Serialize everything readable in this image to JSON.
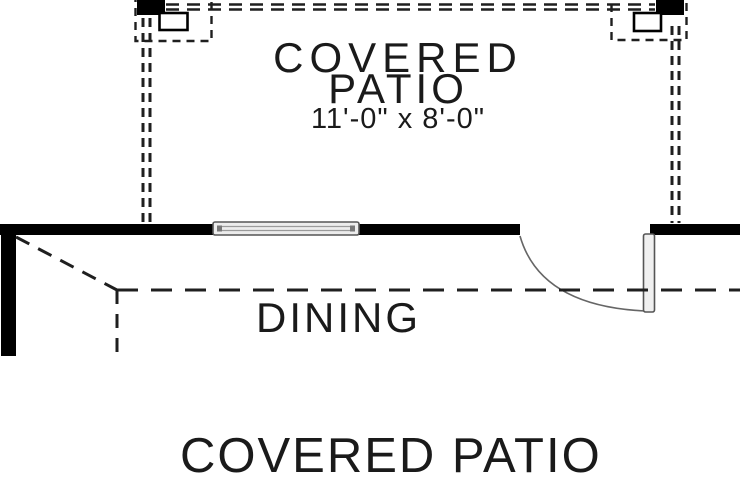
{
  "plan": {
    "patio_label_line1": "COVERED",
    "patio_label_line2": "PATIO",
    "patio_dimensions": "11'-0\" x 8'-0\"",
    "dining_label": "DINING",
    "title": "COVERED PATIO"
  },
  "legend": {
    "elements": [
      "left-roof-post",
      "right-roof-post",
      "roof-overhang-dashed-line",
      "exterior-wall",
      "window",
      "door-swing",
      "dining-boundary-dashed-line"
    ]
  },
  "colors": {
    "background": "#ffffff",
    "wall": "#000000",
    "text": "#1a1a1a",
    "dashed_line": "#1f1f1f",
    "window_fill": "#ececec",
    "window_stroke": "#555555",
    "door_stroke": "#666666",
    "door_leaf_fill": "#f0f0f0"
  }
}
